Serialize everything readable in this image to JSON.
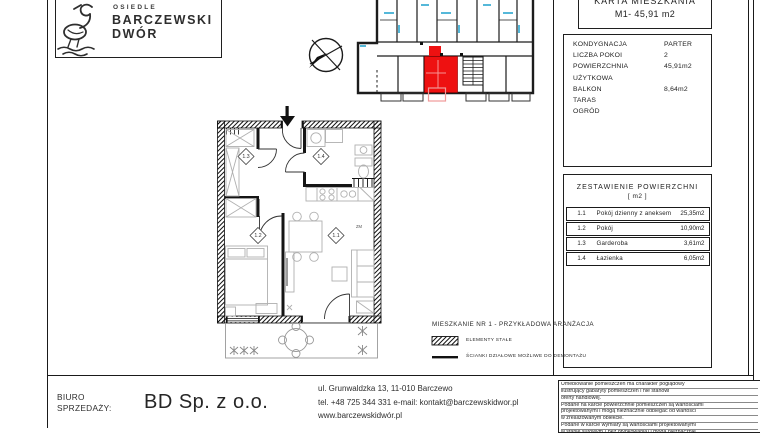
{
  "logo": {
    "estate": "OSIEDLE",
    "name_line1": "BARCZEWSKI",
    "name_line2": "DWÓR"
  },
  "title": {
    "line1": "KARTA MIESZKANIA",
    "line2": "M1- 45,91 m2"
  },
  "info": {
    "rows": [
      {
        "label": "KONDYGNACJA",
        "value": "PARTER"
      },
      {
        "label": "LICZBA  POKOI",
        "value": "2"
      },
      {
        "label": "POWIERZCHNIA UŻYTKOWA",
        "value": "45,91m2"
      },
      {
        "label": "BALKON",
        "value": "8,64m2"
      },
      {
        "label": "TARAS",
        "value": ""
      },
      {
        "label": "OGRÓD",
        "value": ""
      }
    ]
  },
  "area_table": {
    "title": "ZESTAWIENIE  POWIERZCHNI",
    "unit": "[ m2 ]",
    "rows": [
      {
        "no": "1.1",
        "name": "Pokój dzienny z aneksem",
        "value": "25,35m2"
      },
      {
        "no": "1.2",
        "name": "Pokój",
        "value": "10,90m2"
      },
      {
        "no": "1.3",
        "name": "Garderoba",
        "value": "3,61m2"
      },
      {
        "no": "1.4",
        "name": "Łazienka",
        "value": "6,05m2"
      }
    ]
  },
  "plan": {
    "rooms": {
      "r11": "1.1",
      "r12": "1.2",
      "r13": "1.3",
      "r14": "1.4"
    },
    "zm": "ZM",
    "legend": {
      "title": "MIESZKANIE NR 1 - PRZYKŁADOWA  ARANŻACJA",
      "fixed": "ELEMENTY STAŁE",
      "demountable": "ŚCIANKI DZIAŁOWE MOŻLIWE DO DEMONTAŻU"
    }
  },
  "footer": {
    "office_line1": "BIURO",
    "office_line2": "SPRZEDAŻY:",
    "company": "BD Sp. z o.o.",
    "address_line1": "ul. Grunwaldzka 13,  11-010  Barczewo",
    "address_line2": "tel. +48 725 344 331 e-mail: kontakt@barczewskidwor.pl",
    "address_line3": "www.barczewskidwór.pl"
  },
  "disclaimer": {
    "lines": [
      "Umeblowanie pomieszczeń ma charakter poglądowy",
      "ilustrujący gabaryty pomieszczeń i nie stanowi",
      "oferty handlowej.",
      "Podane na karcie powierzchnie pomieszczeń są wartościami",
      "projektowanymi i mogą nieznacznie odbiegać od wartości",
      "w zrealizowanym obiekcie.",
      "Podane w karcie wymiary są wartościami projektowanymi",
      "w stanie surowym ( bez otynkowania) i mogą nieznacznie"
    ]
  },
  "colors": {
    "accent_red": "#ee1111",
    "window_cyan": "#55b8d9"
  }
}
